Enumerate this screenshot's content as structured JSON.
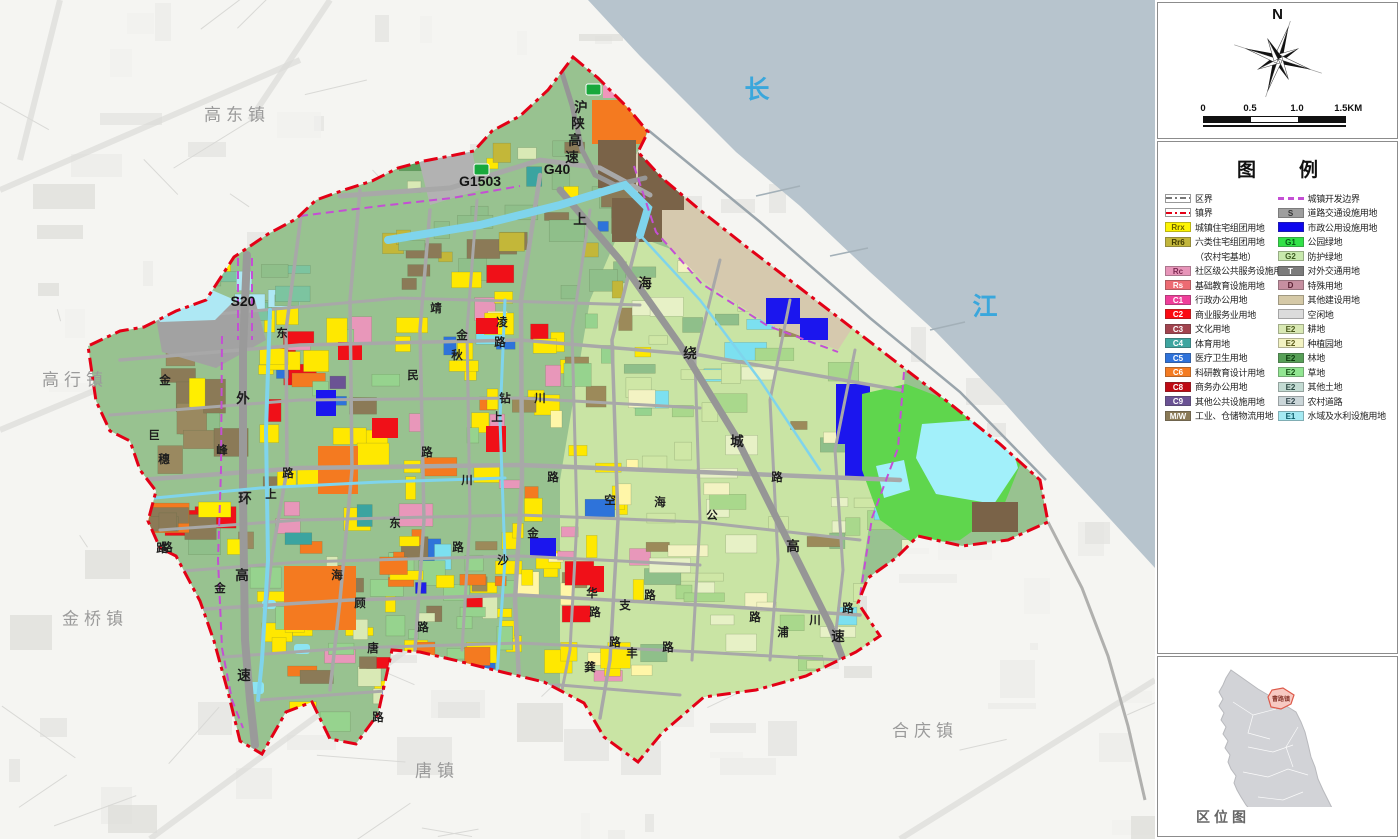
{
  "map": {
    "labels": [
      {
        "t": "高东镇",
        "x": 237,
        "y": 113,
        "c": "town"
      },
      {
        "t": "高行镇",
        "x": 75,
        "y": 378,
        "c": "town"
      },
      {
        "t": "金桥镇",
        "x": 95,
        "y": 617,
        "c": "town"
      },
      {
        "t": "唐镇",
        "x": 437,
        "y": 769,
        "c": "town"
      },
      {
        "t": "合庆镇",
        "x": 925,
        "y": 729,
        "c": "town"
      },
      {
        "t": "长",
        "x": 757,
        "y": 88,
        "c": "river"
      },
      {
        "t": "江",
        "x": 985,
        "y": 305,
        "c": "river"
      },
      {
        "t": "G1503",
        "x": 480,
        "y": 181,
        "c": "shield"
      },
      {
        "t": "G40",
        "x": 557,
        "y": 169,
        "c": "shield"
      },
      {
        "t": "S20",
        "x": 243,
        "y": 301,
        "c": "shield"
      },
      {
        "t": "沪",
        "x": 581,
        "y": 106,
        "c": "hwy"
      },
      {
        "t": "陕",
        "x": 578,
        "y": 122,
        "c": "hwy"
      },
      {
        "t": "高",
        "x": 575,
        "y": 139,
        "c": "hwy"
      },
      {
        "t": "速",
        "x": 572,
        "y": 156,
        "c": "hwy"
      },
      {
        "t": "上",
        "x": 580,
        "y": 218,
        "c": "hwy"
      },
      {
        "t": "海",
        "x": 645,
        "y": 282,
        "c": "hwy"
      },
      {
        "t": "绕",
        "x": 690,
        "y": 352,
        "c": "hwy"
      },
      {
        "t": "城",
        "x": 737,
        "y": 440,
        "c": "hwy"
      },
      {
        "t": "高",
        "x": 793,
        "y": 545,
        "c": "hwy"
      },
      {
        "t": "速",
        "x": 838,
        "y": 635,
        "c": "hwy"
      },
      {
        "t": "外",
        "x": 243,
        "y": 397,
        "c": "hwy"
      },
      {
        "t": "环",
        "x": 245,
        "y": 497,
        "c": "hwy"
      },
      {
        "t": "高",
        "x": 242,
        "y": 574,
        "c": "hwy"
      },
      {
        "t": "速",
        "x": 244,
        "y": 674,
        "c": "hwy"
      },
      {
        "t": "金",
        "x": 165,
        "y": 380,
        "c": "road"
      },
      {
        "t": "巨",
        "x": 154,
        "y": 435,
        "c": "road"
      },
      {
        "t": "穗",
        "x": 164,
        "y": 459,
        "c": "road"
      },
      {
        "t": "峰",
        "x": 222,
        "y": 450,
        "c": "road"
      },
      {
        "t": "路",
        "x": 167,
        "y": 547,
        "c": "road"
      },
      {
        "t": "东",
        "x": 282,
        "y": 333,
        "c": "road"
      },
      {
        "t": "路",
        "x": 288,
        "y": 473,
        "c": "road"
      },
      {
        "t": "上",
        "x": 271,
        "y": 494,
        "c": "road"
      },
      {
        "t": "靖",
        "x": 436,
        "y": 308,
        "c": "road"
      },
      {
        "t": "金",
        "x": 462,
        "y": 335,
        "c": "road"
      },
      {
        "t": "秋",
        "x": 457,
        "y": 355,
        "c": "road"
      },
      {
        "t": "凌",
        "x": 502,
        "y": 322,
        "c": "road"
      },
      {
        "t": "路",
        "x": 500,
        "y": 342,
        "c": "road"
      },
      {
        "t": "民",
        "x": 413,
        "y": 375,
        "c": "road"
      },
      {
        "t": "路",
        "x": 427,
        "y": 452,
        "c": "road"
      },
      {
        "t": "钻",
        "x": 505,
        "y": 398,
        "c": "road"
      },
      {
        "t": "川",
        "x": 540,
        "y": 398,
        "c": "road"
      },
      {
        "t": "上",
        "x": 497,
        "y": 417,
        "c": "road"
      },
      {
        "t": "川",
        "x": 467,
        "y": 480,
        "c": "road"
      },
      {
        "t": "路",
        "x": 553,
        "y": 477,
        "c": "road"
      },
      {
        "t": "东",
        "x": 395,
        "y": 523,
        "c": "road"
      },
      {
        "t": "金",
        "x": 533,
        "y": 533,
        "c": "road"
      },
      {
        "t": "路",
        "x": 458,
        "y": 547,
        "c": "road"
      },
      {
        "t": "沙",
        "x": 503,
        "y": 560,
        "c": "road"
      },
      {
        "t": "路",
        "x": 423,
        "y": 627,
        "c": "road"
      },
      {
        "t": "空",
        "x": 610,
        "y": 500,
        "c": "road"
      },
      {
        "t": "海",
        "x": 660,
        "y": 502,
        "c": "road"
      },
      {
        "t": "公",
        "x": 712,
        "y": 515,
        "c": "road"
      },
      {
        "t": "路",
        "x": 777,
        "y": 477,
        "c": "road"
      },
      {
        "t": "华",
        "x": 592,
        "y": 593,
        "c": "road"
      },
      {
        "t": "支",
        "x": 625,
        "y": 605,
        "c": "road"
      },
      {
        "t": "路",
        "x": 595,
        "y": 612,
        "c": "road"
      },
      {
        "t": "路",
        "x": 650,
        "y": 595,
        "c": "road"
      },
      {
        "t": "路",
        "x": 755,
        "y": 617,
        "c": "road"
      },
      {
        "t": "路",
        "x": 848,
        "y": 608,
        "c": "road"
      },
      {
        "t": "浦",
        "x": 783,
        "y": 632,
        "c": "road"
      },
      {
        "t": "川",
        "x": 815,
        "y": 620,
        "c": "road"
      },
      {
        "t": "路",
        "x": 615,
        "y": 642,
        "c": "road"
      },
      {
        "t": "路",
        "x": 668,
        "y": 647,
        "c": "road"
      },
      {
        "t": "丰",
        "x": 632,
        "y": 653,
        "c": "road"
      },
      {
        "t": "龚",
        "x": 590,
        "y": 667,
        "c": "road"
      },
      {
        "t": "唐",
        "x": 373,
        "y": 648,
        "c": "road"
      },
      {
        "t": "顾",
        "x": 360,
        "y": 603,
        "c": "road"
      },
      {
        "t": "海",
        "x": 337,
        "y": 575,
        "c": "road"
      },
      {
        "t": "金",
        "x": 220,
        "y": 588,
        "c": "road"
      },
      {
        "t": "路",
        "x": 162,
        "y": 548,
        "c": "road"
      },
      {
        "t": "路",
        "x": 378,
        "y": 717,
        "c": "road"
      }
    ]
  },
  "panels": {
    "north_label": "N",
    "scale": {
      "ticks": [
        "0",
        "0.5",
        "1.0",
        "1.5KM"
      ]
    },
    "legend": {
      "title": "图　例",
      "left": [
        {
          "type": "line",
          "style": "district",
          "label": "区界"
        },
        {
          "type": "line",
          "style": "town",
          "label": "镇界"
        },
        {
          "type": "box",
          "code": "Rrx",
          "color": "#fdf403",
          "tc": "#6a6000",
          "label": "城镇住宅组团用地"
        },
        {
          "type": "box",
          "code": "Rr6",
          "color": "#c2b63c",
          "tc": "#3f3a00",
          "label": "六类住宅组团用地"
        },
        {
          "type": "sub",
          "label": "（农村宅基地）"
        },
        {
          "type": "box",
          "code": "Rc",
          "color": "#e795b9",
          "tc": "#7c2a52",
          "label": "社区级公共服务设施用地"
        },
        {
          "type": "box",
          "code": "Rs",
          "color": "#ed6b72",
          "tc": "#ffffff",
          "label": "基础教育设施用地"
        },
        {
          "type": "box",
          "code": "C1",
          "color": "#ef3e9a",
          "tc": "#ffffff",
          "label": "行政办公用地"
        },
        {
          "type": "box",
          "code": "C2",
          "color": "#fb0a12",
          "tc": "#ffffff",
          "label": "商业服务业用地"
        },
        {
          "type": "box",
          "code": "C3",
          "color": "#a2434e",
          "tc": "#ffffff",
          "label": "文化用地"
        },
        {
          "type": "box",
          "code": "C4",
          "color": "#3ea5a0",
          "tc": "#ffffff",
          "label": "体育用地"
        },
        {
          "type": "box",
          "code": "C5",
          "color": "#2e72da",
          "tc": "#ffffff",
          "label": "医疗卫生用地"
        },
        {
          "type": "box",
          "code": "C6",
          "color": "#f47b21",
          "tc": "#ffffff",
          "label": "科研教育设计用地"
        },
        {
          "type": "box",
          "code": "C8",
          "color": "#bf0a14",
          "tc": "#ffffff",
          "label": "商务办公用地"
        },
        {
          "type": "box",
          "code": "C9",
          "color": "#6a5294",
          "tc": "#ffffff",
          "label": "其他公共设施用地"
        },
        {
          "type": "box",
          "code": "M/W",
          "color": "#8a7a57",
          "tc": "#ffffff",
          "label": "工业、仓储物流用地"
        }
      ],
      "right": [
        {
          "type": "line",
          "style": "dev",
          "label": "城镇开发边界"
        },
        {
          "type": "box",
          "code": "S",
          "color": "#9e9e9e",
          "tc": "#333333",
          "label": "道路交通设施用地"
        },
        {
          "type": "box",
          "code": "",
          "color": "#0d06ee",
          "tc": "#0d06ee",
          "label": "市政公用设施用地"
        },
        {
          "type": "box",
          "code": "G1",
          "color": "#32e148",
          "tc": "#055a16",
          "label": "公园绿地"
        },
        {
          "type": "box",
          "code": "G2",
          "color": "#c8e9ad",
          "tc": "#3b5a20",
          "label": "防护绿地"
        },
        {
          "type": "box",
          "code": "T",
          "color": "#7c7c7c",
          "tc": "#ffffff",
          "label": "对外交通用地"
        },
        {
          "type": "box",
          "code": "D",
          "color": "#c68fa0",
          "tc": "#5a2032",
          "label": "特殊用地"
        },
        {
          "type": "box",
          "code": "",
          "color": "#d5c9a7",
          "tc": "#d5c9a7",
          "label": "其他建设用地"
        },
        {
          "type": "box",
          "code": "",
          "color": "#dcdcdc",
          "tc": "#dcdcdc",
          "label": "空闲地"
        },
        {
          "type": "box",
          "code": "E2",
          "color": "#d9e9b4",
          "tc": "#49581a",
          "label": "耕地"
        },
        {
          "type": "box",
          "code": "E2",
          "color": "#f3f3c2",
          "tc": "#5a5a1a",
          "label": "种植园地"
        },
        {
          "type": "box",
          "code": "E2",
          "color": "#57a057",
          "tc": "#0b3a0b",
          "label": "林地"
        },
        {
          "type": "box",
          "code": "E2",
          "color": "#92e692",
          "tc": "#145014",
          "label": "草地"
        },
        {
          "type": "box",
          "code": "E2",
          "color": "#c3dbd3",
          "tc": "#2c4a44",
          "label": "其他土地"
        },
        {
          "type": "box",
          "code": "E2",
          "color": "#cbd6d9",
          "tc": "#33474d",
          "label": "农村道路"
        },
        {
          "type": "box",
          "code": "E1",
          "color": "#a5eaf3",
          "tc": "#0b5a66",
          "label": "水域及水利设施用地"
        }
      ]
    },
    "locator": {
      "caption": "区位图",
      "highlight_label": "曹路镇"
    }
  },
  "colors": {
    "water": "#b7c4cd",
    "tidal_flat": "#d6c9ae",
    "town_base": "#98c290",
    "east_fields": "#c9e4a4",
    "town_boundary": "#e30016",
    "dev_boundary": "#c44fd4",
    "river_text": "#3aa7dc"
  }
}
